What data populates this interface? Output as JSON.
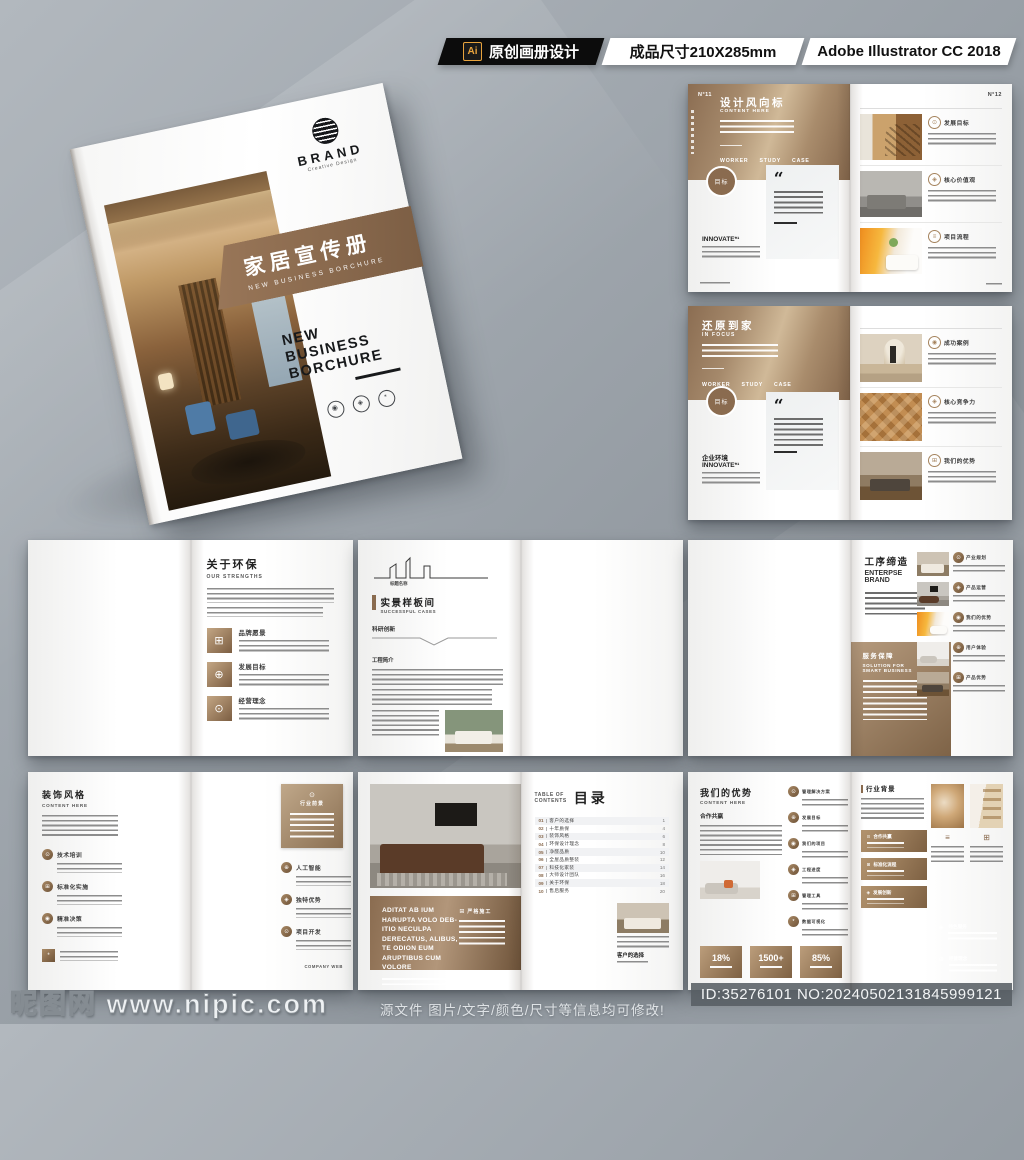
{
  "top_bar": {
    "ai_badge": "Ai",
    "label": "原创画册设计",
    "size": "成品尺寸210X285mm",
    "software": "Adobe Illustrator CC 2018"
  },
  "colors": {
    "brand_brown": "#8a6b4f",
    "brown_dark": "#6e5238",
    "brown_light": "#c9b296",
    "background_gray": "#9aa1a8"
  },
  "icons": {
    "quote": "“",
    "target": "⊙",
    "grid": "⊞",
    "people": "⊕",
    "gem": "◈",
    "lines": "≡",
    "medal": "◉",
    "check": "✓",
    "star": "*",
    "dot": "●"
  },
  "cover": {
    "brand": "BRAND",
    "brand_sub": "Creative Design",
    "band_title": "家居宣传册",
    "band_sub": "NEW BUSINESS BORCHURE",
    "title_line1": "NEW",
    "title_line2": "BUSINESS",
    "title_line3": "BORCHURE"
  },
  "spread_trend": {
    "page_left": "N°11",
    "page_right": "N°12",
    "title": "设计风向标",
    "subtitle": "CONTENT HERE",
    "tabs": [
      "WORKER",
      "STUDY",
      "CASE"
    ],
    "badge": "目标",
    "innovate": "INNOVATE*¹",
    "items": [
      {
        "label": "发展目标"
      },
      {
        "label": "核心价值观"
      },
      {
        "label": "项目流程"
      }
    ]
  },
  "spread_focus": {
    "title": "还原到家",
    "subtitle": "IN FOCUS",
    "tabs": [
      "WORKER",
      "STUDY",
      "CASE"
    ],
    "badge": "目标",
    "env": "企业环境",
    "innovate": "INNOVATE*¹",
    "items": [
      {
        "label": "成功案例"
      },
      {
        "label": "核心竞争力"
      },
      {
        "label": "我们的优势"
      }
    ]
  },
  "spread_about": {
    "photo_title": "市场分析",
    "photo_sub": "CREATIVE / DESIGN",
    "title": "关于环保",
    "subtitle": "OUR STRENGTHS",
    "items": [
      {
        "label": "品牌愿景"
      },
      {
        "label": "发展目标"
      },
      {
        "label": "经营理念"
      }
    ]
  },
  "spread_cases": {
    "skyline_label": "标题名称",
    "title": "实景样板间",
    "subtitle": "SUCCESSFUL CASES",
    "sec1": "科研创新",
    "sec2": "工程简介"
  },
  "spread_enterprise": {
    "bubble": "价值观念",
    "title": "工序缔造",
    "subtitle_1": "ENTERPSE",
    "subtitle_2": "BRAND",
    "service_title": "服务保障",
    "service_sub_1": "SOLUTION FOR",
    "service_sub_2": "SMART BUSINESS",
    "items": [
      "产业规划",
      "产品运营",
      "我们的优势",
      "用户体验",
      "产品优势"
    ]
  },
  "spread_style": {
    "title": "装饰风格",
    "subtitle": "CONTENT HERE",
    "left_items": [
      "技术培训",
      "标准化实施",
      "精准决策"
    ],
    "card_title": "行业前景",
    "right_items": [
      "人工智能",
      "独特优势",
      "项目开发"
    ],
    "footer": "COMPANY WEB"
  },
  "spread_toc": {
    "label_1": "TABLE OF",
    "label_2": "CONTENTS",
    "title": "目录",
    "items": [
      {
        "num": "01",
        "title": "客户的选择",
        "page": "1"
      },
      {
        "num": "02",
        "title": "十年质保",
        "page": "4"
      },
      {
        "num": "03",
        "title": "装饰风格",
        "page": "6"
      },
      {
        "num": "04",
        "title": "环保设计理念",
        "page": "8"
      },
      {
        "num": "05",
        "title": "净醛品质",
        "page": "10"
      },
      {
        "num": "06",
        "title": "全屋品质整装",
        "page": "12"
      },
      {
        "num": "07",
        "title": "科技化家装",
        "page": "14"
      },
      {
        "num": "08",
        "title": "大师设计团队",
        "page": "16"
      },
      {
        "num": "09",
        "title": "关于环保",
        "page": "18"
      },
      {
        "num": "10",
        "title": "售后服务",
        "page": "20"
      }
    ],
    "banner_text": "ADITAT AB IUM HARUPTA VOLO DEB-ITIO NECULPA DERECATUS, ALIBUS, TE ODION EUM ARUPTIBUS CUM VOLORE",
    "banner_label": "严格施工",
    "mini_title": "客户的选择"
  },
  "spread_advantage": {
    "title": "我们的优势",
    "subtitle": "CONTENT HERE",
    "sec": "合作共赢",
    "stats": [
      "18%",
      "1500+",
      "85%"
    ],
    "icon_items": [
      "管理解决方案",
      "发展目标",
      "我们的项目",
      "工程进度",
      "管理工具",
      "数据可视化"
    ],
    "right_header": "行业背景",
    "chips": [
      "合作共赢",
      "标准化流程",
      "发展创新"
    ],
    "panel_items": [
      "业务范围",
      "特色服务",
      "科学研判",
      "经营理念"
    ]
  },
  "watermark": {
    "site": "昵图网",
    "url": "www.nipic.com",
    "note": "源文件 图片/文字/颜色/尺寸等信息均可修改!",
    "id": "ID:35276101 NO:20240502131845999121"
  }
}
